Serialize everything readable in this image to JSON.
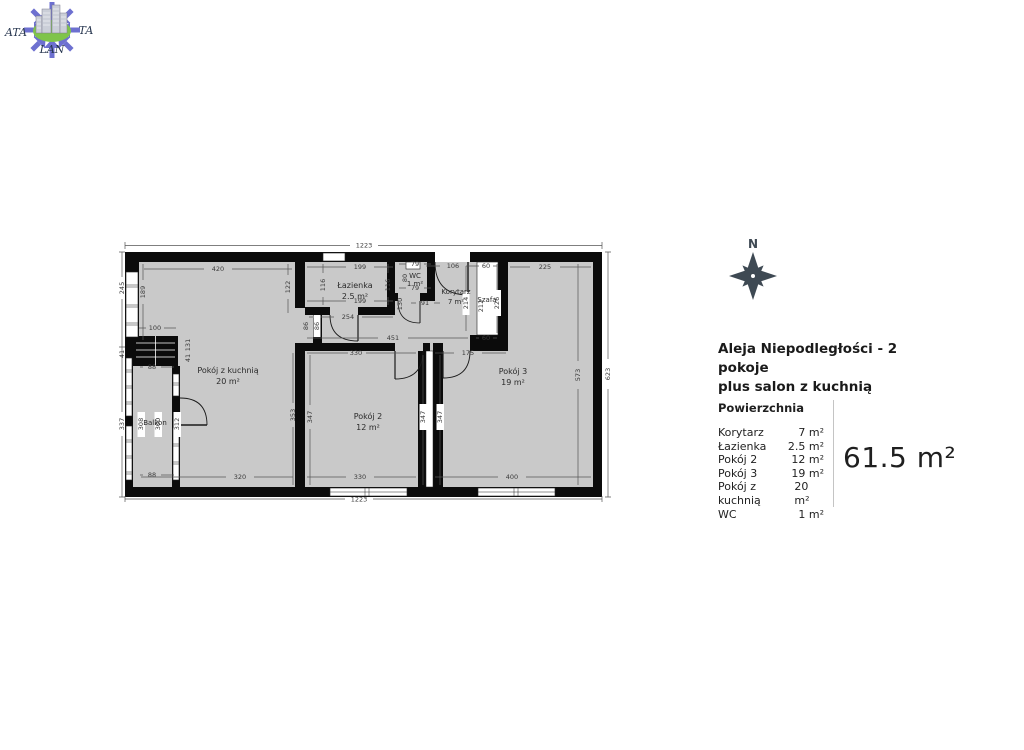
{
  "logo": {
    "text_left": "ATA",
    "text_right": "TA",
    "text_bottom": "LAN"
  },
  "compass": {
    "north_label": "N"
  },
  "listing": {
    "title_line1": "Aleja Niepodległości - 2 pokoje",
    "title_line2": "plus salon z kuchnią",
    "area_table": {
      "header": "Powierzchnia",
      "rows": [
        {
          "name": "Korytarz",
          "area": "7 m²"
        },
        {
          "name": "Łazienka",
          "area": "2.5 m²"
        },
        {
          "name": "Pokój 2",
          "area": "12 m²"
        },
        {
          "name": "Pokój 3",
          "area": "19 m²"
        },
        {
          "name": "Pokój z kuchnią",
          "area": "20 m²"
        },
        {
          "name": "WC",
          "area": "1 m²"
        }
      ],
      "total": "61.5 m²"
    }
  },
  "floorplan": {
    "rooms": [
      {
        "name": "Pokój z kuchnią",
        "area": "20 m²"
      },
      {
        "name": "Łazienka",
        "area": "2.5 m²"
      },
      {
        "name": "WC",
        "area": "1 m²"
      },
      {
        "name": "Korytarz",
        "area": "7 m²"
      },
      {
        "name": "Szafa",
        "area": ""
      },
      {
        "name": "Pokój 2",
        "area": "12 m²"
      },
      {
        "name": "Pokój 3",
        "area": "19 m²"
      },
      {
        "name": "Balkon",
        "area": ""
      }
    ],
    "dims": [
      "1223",
      "420",
      "199",
      "79",
      "106",
      "60",
      "225",
      "245",
      "189",
      "122",
      "116",
      "116",
      "80",
      "79",
      "91",
      "130",
      "199",
      "254",
      "86",
      "86",
      "451",
      "214",
      "212",
      "226",
      "60",
      "100",
      "131",
      "41",
      "41",
      "88",
      "337",
      "308",
      "300",
      "312",
      "88",
      "320",
      "330",
      "175",
      "353",
      "347",
      "347",
      "347",
      "330",
      "400",
      "1223",
      "573",
      "623"
    ],
    "colors": {
      "floor": "#c9c9c9",
      "wall": "#0b0b0b",
      "dim_text": "#3a3a3a",
      "compass": "#3e4953",
      "logo_blue": "#585cc9",
      "logo_green": "#79c141"
    }
  }
}
